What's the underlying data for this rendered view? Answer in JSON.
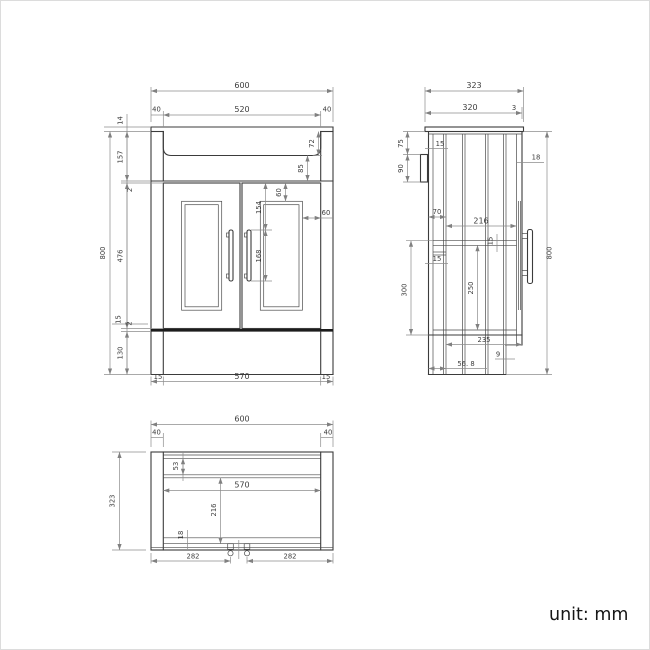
{
  "unit_label": "unit: mm",
  "front_view": {
    "width_overall": "600",
    "basin_width": "520",
    "worktop_end_left": "40",
    "worktop_end_right": "40",
    "worktop_thickness": "14",
    "top_section_height": "157",
    "top_gap": "2",
    "basin_depth": "72",
    "basin_to_doors": "85",
    "height_overall": "800",
    "door_height": "476",
    "panel_top_inset": "60",
    "handle_top_offset": "154",
    "handle_length": "168",
    "panel_side_inset": "60",
    "bottom_rail": "15",
    "bottom_gap": "2",
    "plinth_height": "130",
    "base_end_left": "15",
    "base_width": "570",
    "base_end_right": "15"
  },
  "side_view": {
    "depth_overall": "323",
    "worktop_depth": "320",
    "worktop_lip": "3",
    "back_panel_thickness": "15",
    "bracket_top_offset": "75",
    "bracket_height": "90",
    "top_rail_depth": "70",
    "door_thickness": "18",
    "shelf_depth": "216",
    "shelf_thickness": "15",
    "back_rail_thickness": "15",
    "shelf_to_plinth": "300",
    "clear_height": "250",
    "height_overall": "800",
    "bottom_depth": "235",
    "plinth_thickness": "9",
    "plinth_recess": "56. 8"
  },
  "plan_view": {
    "width_overall": "600",
    "side_panel_left": "40",
    "side_panel_right": "40",
    "depth_overall": "323",
    "back_rail_depth": "53",
    "inner_width": "570",
    "inner_depth": "216",
    "front_rail_depth": "18",
    "fixing_span_left": "282",
    "fixing_span_right": "282"
  }
}
